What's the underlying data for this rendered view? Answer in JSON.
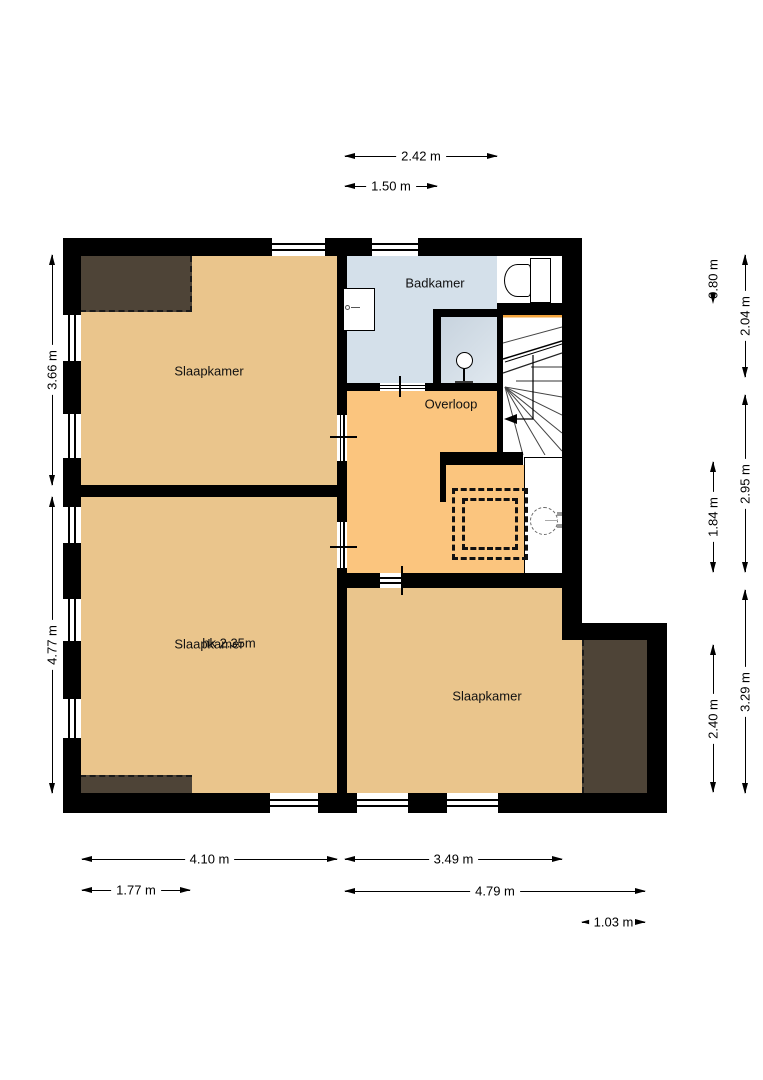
{
  "plan_title": "Verdieping plattegrond",
  "rooms": {
    "tl": "Slaapkamer",
    "ml": "Slaapkamer",
    "ml_note": "hk 2.35m",
    "br": "Slaapkamer",
    "bad": "Badkamer",
    "overloop": "Overloop"
  },
  "dims": {
    "top1": "2.42 m",
    "top2": "1.50 m",
    "left1": "3.66 m",
    "left2": "4.77 m",
    "right_inner1": "0.80 m",
    "right_inner2": "1.84 m",
    "right_inner3": "2.40 m",
    "right_outer1": "2.04 m",
    "right_outer2": "2.95 m",
    "right_outer3": "3.29 m",
    "bottom1": "4.10 m",
    "bottom2": "3.49 m",
    "bottom3": "1.77 m",
    "bottom4": "4.79 m",
    "bottom5": "1.03 m"
  },
  "fixtures": {
    "stairs": "stairs-with-winders",
    "boiler": "boiler-dashed-circle",
    "toilet": "toilet",
    "sink": "sink",
    "shower": "shower",
    "hatch": "dashed-roof-opening"
  },
  "colors": {
    "wall": "#000000",
    "room_fill": "#eac58c",
    "hall_fill": "#fbc57e",
    "bath_fill": "#d4e0ea",
    "shower_a": "#c7d3de",
    "shower_b": "#e0e8ef",
    "roof_zone": "#4e4437",
    "stair_accent": "#f2a33c"
  }
}
